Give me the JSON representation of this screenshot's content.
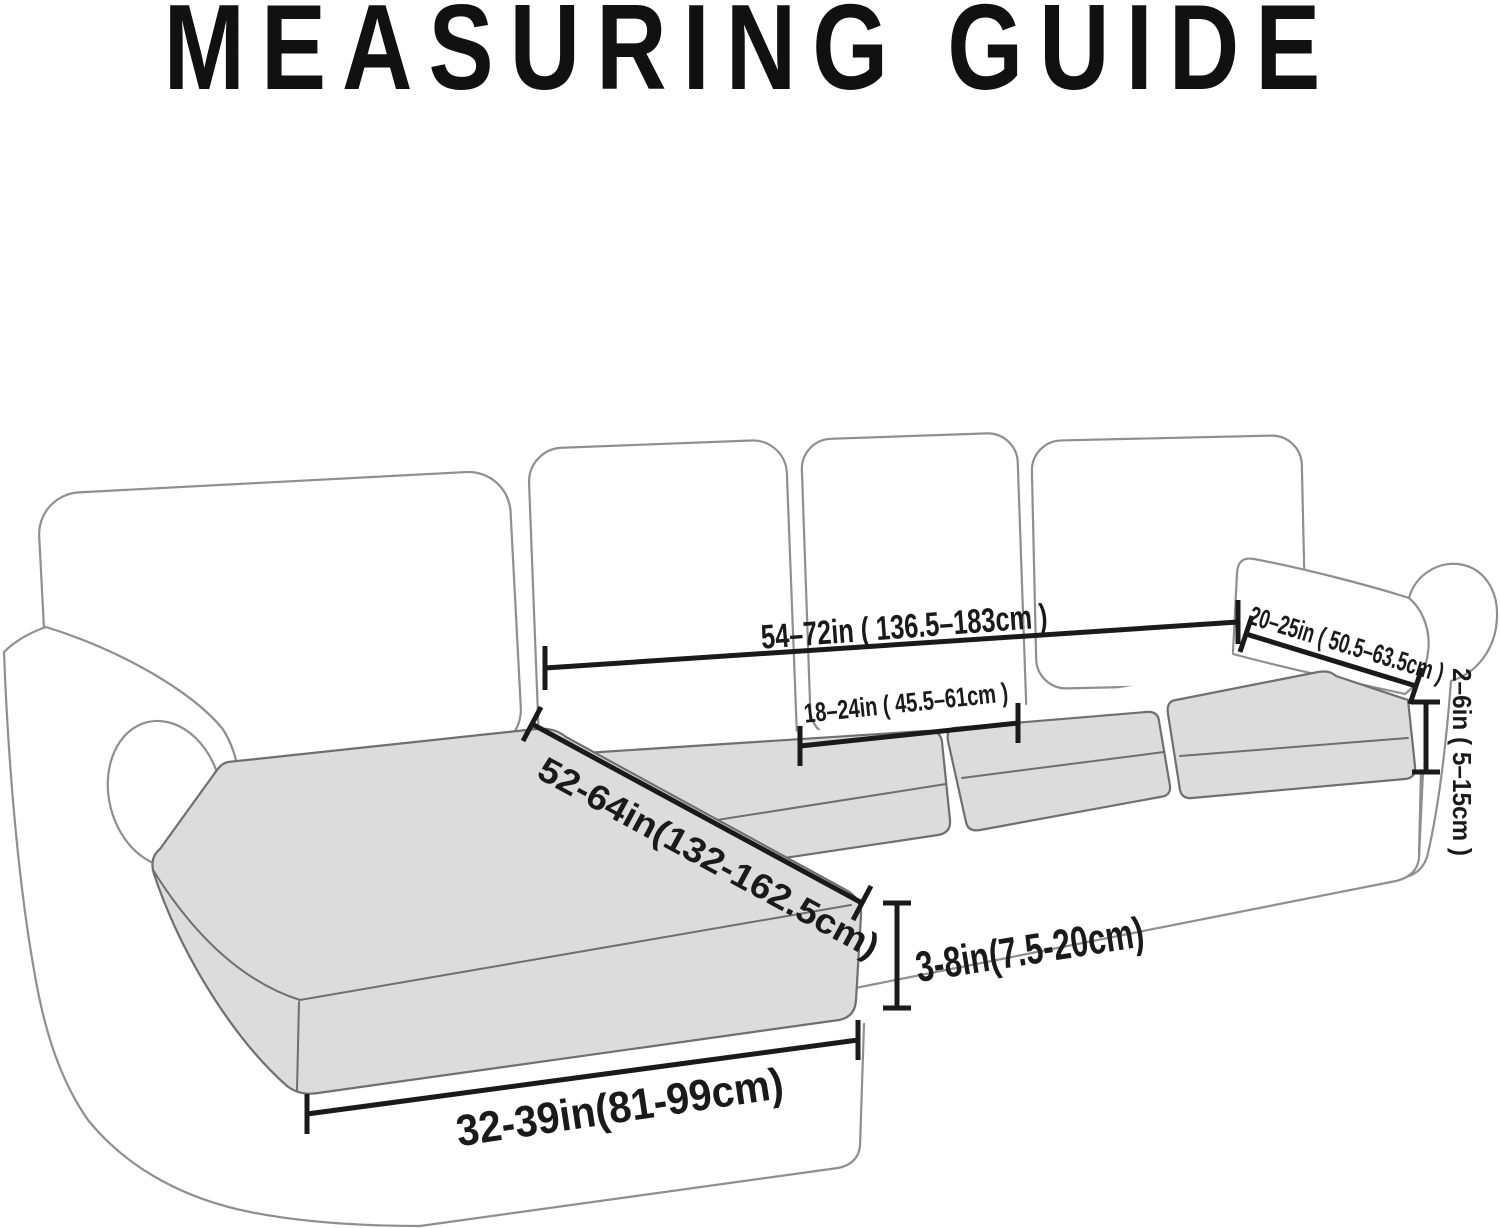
{
  "title": {
    "text": "MEASURING GUIDE",
    "color": "#111111"
  },
  "diagram": {
    "type": "sectional-sofa-cushion-measuring-guide",
    "colors": {
      "background": "#ffffff",
      "furniture_line": "#8f8f8f",
      "cushion_fill": "#dcdcdc",
      "cushion_line": "#6f6f6f",
      "annotation": "#1a1a1a"
    },
    "parts": [
      "back-cushion-1",
      "back-cushion-2",
      "back-cushion-3",
      "back-cushion-4",
      "left-arm",
      "right-arm",
      "chaise-seat-cushion",
      "seat-cushion-2",
      "seat-cushion-3",
      "seat-cushion-4",
      "sofa-base"
    ],
    "measurements": [
      {
        "id": "back-width",
        "label": "54–72in ( 136.5–183cm )"
      },
      {
        "id": "seat-cushion-width",
        "label": "18–24in ( 45.5–61cm )"
      },
      {
        "id": "arm-cover-length",
        "label": "20–25in ( 50.5–63.5cm )"
      },
      {
        "id": "arm-side-height",
        "label": "2–6in ( 5–15cm )"
      },
      {
        "id": "chaise-length",
        "label": "52-64in(132-162.5cm)"
      },
      {
        "id": "cushion-thickness",
        "label": "3-8in(7.5-20cm)"
      },
      {
        "id": "chaise-width",
        "label": "32-39in(81-99cm)"
      }
    ]
  }
}
